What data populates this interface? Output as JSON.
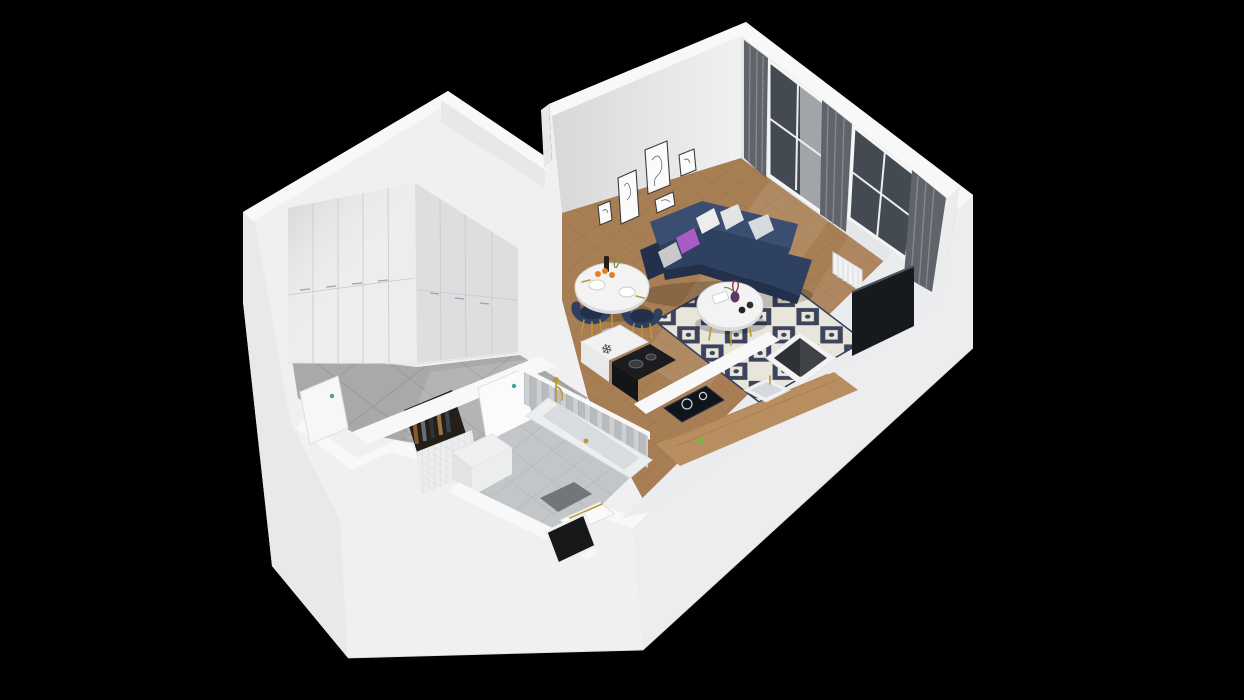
{
  "scene": {
    "kind": "3d-isometric-apartment-floor-plan-render",
    "background": "#000000",
    "rooms": [
      {
        "name": "hallway",
        "floor": "large-gray-tiles",
        "objects": [
          "floor-to-ceiling-wardrobe",
          "coat-niche-with-hanging-clothes",
          "entry-door"
        ]
      },
      {
        "name": "bathroom",
        "floor": "light-gray-tiles",
        "objects": [
          "bathtub",
          "gold-shower-set",
          "chevron-tile-wall",
          "mosaic-tile-wall",
          "vanity-unit",
          "floor-mat",
          "towel-niche",
          "bathroom-door"
        ]
      },
      {
        "name": "kitchen",
        "floor": "herringbone-wood",
        "objects": [
          "refrigerator-with-snowflake-mark",
          "black-stove",
          "induction-hob",
          "wood-countertop",
          "sink-with-gold-faucet",
          "green-apple",
          "storage-shaft"
        ]
      },
      {
        "name": "living-dining-room",
        "floor": "herringbone-wood",
        "objects": [
          "navy-corner-sofa",
          "five-pillows",
          "patterned-rug",
          "round-coffee-table",
          "vase-with-flowers",
          "candles",
          "tv-screen",
          "radiator",
          "two-windows-with-gray-curtains",
          "gallery-of-five-wall-frames",
          "round-dining-table",
          "two-navy-chairs",
          "bottle-and-fruit"
        ]
      }
    ]
  },
  "icons": {
    "snowflake_glyph": "❄",
    "snowflake_meaning": "refrigerator-icon"
  },
  "colors": {
    "background": "#000000",
    "wallWhite": "#f0f0f2",
    "wallTop": "#f8f8f9",
    "wallFaceLight": "#ebecee",
    "wallFaceShade": "#e0e2e5",
    "windowsWallFace": "#e4e6e8",
    "wood": "#a87e54",
    "woodLine": "#8d6743",
    "hallTile": "#a7a9aa",
    "hallTileLine": "#909293",
    "bathTile": "#c3c6c8",
    "bathTileLine": "#aeb1b3",
    "rugBase": "#e7e3d8",
    "rugPattern": "#2c3550",
    "sofa": "#2e4160",
    "sofaDark": "#22304b",
    "sofaLight": "#3a4e71",
    "pillowWhite": "#ededee",
    "pillowGray": "#c9c9cc",
    "pillowPurple": "#a85cc6",
    "curtain": "#60646a",
    "curtainStreak": "#8d9197",
    "sheer": "#eef0f3",
    "glass": "#434a52",
    "tableWhite": "#f3f3f4",
    "gold": "#bd9733",
    "chairNavy": "#2e3f60",
    "counterWood": "#b88e60",
    "applianceBlack": "#1b1c1e",
    "hob": "#10151c",
    "tvBlack": "#16191d",
    "tvEdge": "#49565f",
    "radiatorWhite": "#f1f2f3",
    "nicheDark": "#241f19",
    "teal": "#3aa8a0",
    "mat": "#70767a",
    "chevron": "#b9bcbe",
    "mosaic": "#ededee",
    "vase": "#5e3761",
    "apple": "#7cb342",
    "orange": "#e2801f",
    "bottle": "#241f1c",
    "greenery": "#6d8f46"
  }
}
